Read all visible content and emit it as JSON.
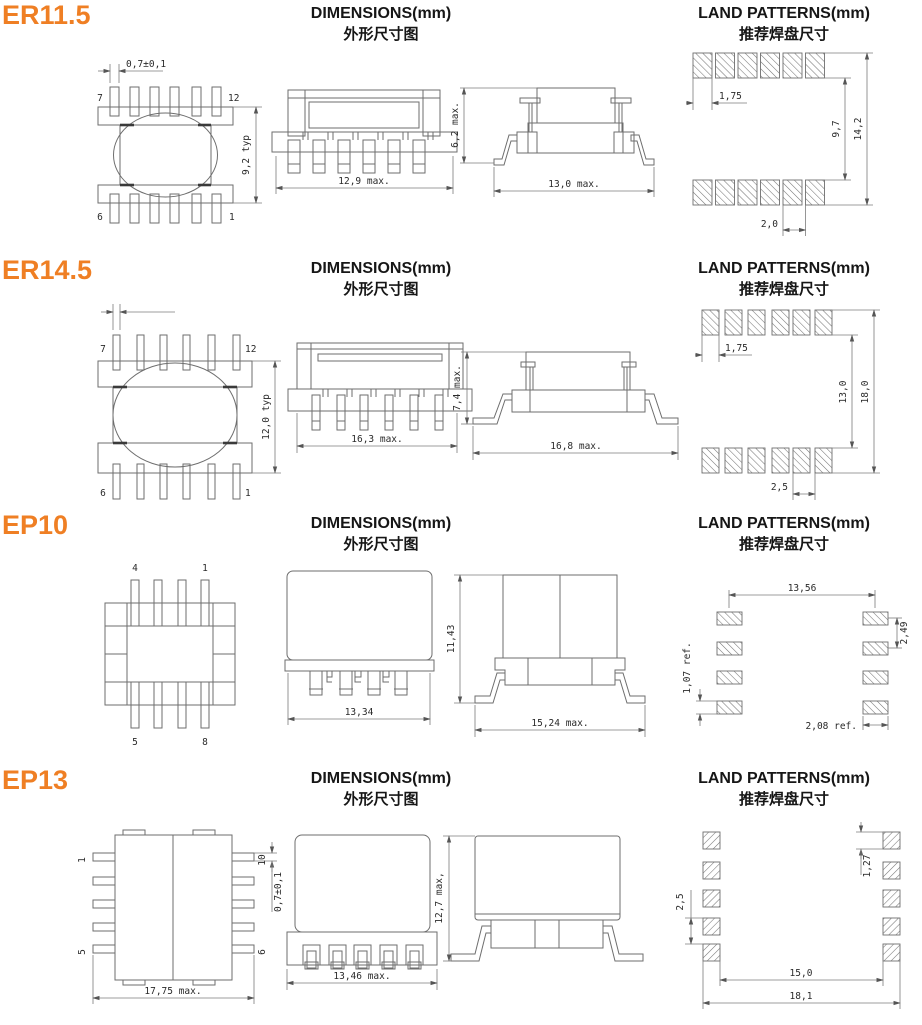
{
  "sections": [
    {
      "name": "ER11.5",
      "dims_title": "DIMENSIONS(mm)",
      "dims_subtitle": "外形尺寸图",
      "land_title": "LAND PATTERNS(mm)",
      "land_subtitle": "推荐焊盘尺寸",
      "top_view": {
        "pin_tl": "7",
        "pin_tr": "12",
        "pin_bl": "6",
        "pin_br": "1",
        "pin_width": "0,7±0,1",
        "height": "9,2 typ"
      },
      "front_view": {
        "width": "12,9 max."
      },
      "side_view": {
        "height": "6,2 max.",
        "width": "13,0 max."
      },
      "land": {
        "pad_width": "1,75",
        "inner_span": "9,7",
        "outer_span": "14,2",
        "pitch": "2,0"
      }
    },
    {
      "name": "ER14.5",
      "dims_title": "DIMENSIONS(mm)",
      "dims_subtitle": "外形尺寸图",
      "land_title": "LAND PATTERNS(mm)",
      "land_subtitle": "推荐焊盘尺寸",
      "top_view": {
        "pin_tl": "7",
        "pin_tr": "12",
        "pin_bl": "6",
        "pin_br": "1",
        "height": "12,0 typ"
      },
      "front_view": {
        "width": "16,3 max."
      },
      "side_view": {
        "height": "7,4 max.",
        "width": "16,8 max."
      },
      "land": {
        "pad_width": "1,75",
        "inner_span": "13,0",
        "outer_span": "18,0",
        "pitch": "2,5"
      }
    },
    {
      "name": "EP10",
      "dims_title": "DIMENSIONS(mm)",
      "dims_subtitle": "外形尺寸图",
      "land_title": "LAND PATTERNS(mm)",
      "land_subtitle": "推荐焊盘尺寸",
      "top_view": {
        "pin_tl": "4",
        "pin_tr": "1",
        "pin_bl": "5",
        "pin_br": "8"
      },
      "front_view": {
        "width": "13,34"
      },
      "side_view": {
        "height": "11,43",
        "width": "15,24 max."
      },
      "land": {
        "center_span": "13,56",
        "pad_height": "1,07 ref.",
        "pitch": "2,49",
        "pad_width": "2,08 ref."
      }
    },
    {
      "name": "EP13",
      "dims_title": "DIMENSIONS(mm)",
      "dims_subtitle": "外形尺寸图",
      "land_title": "LAND PATTERNS(mm)",
      "land_subtitle": "推荐焊盘尺寸",
      "top_view": {
        "pin_tl": "1",
        "pin_tr": "10",
        "pin_bl": "5",
        "pin_br": "6",
        "pin_width": "0,7±0,1",
        "width": "17,75 max."
      },
      "front_view": {
        "width": "13,46 max."
      },
      "side_view": {
        "height": "12,7 max,"
      },
      "land": {
        "pitch": "2,5",
        "pad_height": "1,27",
        "inner_span": "15,0",
        "outer_span": "18,1"
      }
    }
  ]
}
